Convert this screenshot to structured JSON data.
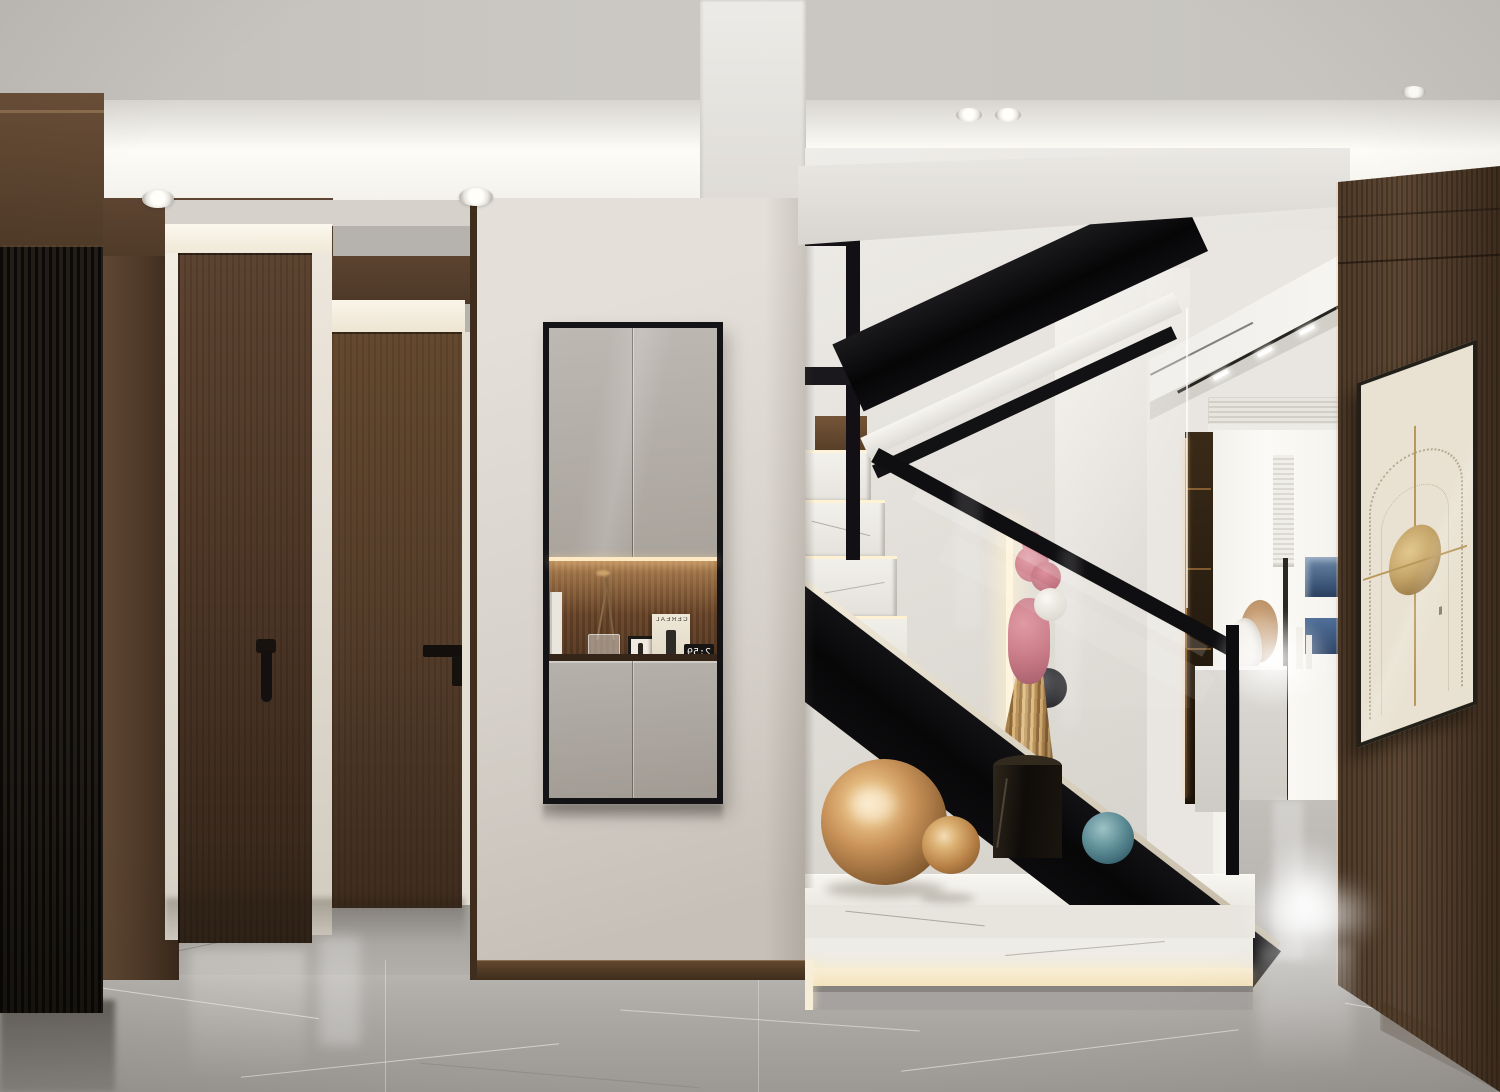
{
  "meta": {
    "type": "interior-render",
    "description": "Modern luxury home entry hall: dark walnut doors and black fluted panel on the left, greige wall with black-framed mirror shoe cabinet and lit display niche in the center, black steel staircase with glass balustrade and white marble platform with copper spheres at right, walnut feature wall with framed line artwork on the far right, gray marble floor, recessed cove-lit ceiling.",
    "canvas": {
      "width": 1500,
      "height": 1092
    }
  },
  "scene": {
    "ceiling": {
      "style": "recessed tray with warm cove lighting",
      "downlight_count": 5
    },
    "left_hallway": {
      "fluted_panel": "black vertical slatted panel",
      "doors": [
        {
          "label": "walnut door with black drop handle"
        },
        {
          "label": "walnut door with black bar handle"
        }
      ]
    },
    "entry_cabinet": {
      "label": "wall-hung cabinet, taupe doors, black frame",
      "niche": {
        "label": "wood-slat display niche with LED strip",
        "items": [
          "dried branches in glass vase",
          "small black photo frame",
          "magazine cover (mirrored)",
          "flip clock (mirrored)"
        ],
        "magazine_title": "CEREAL",
        "clock_time": "2:59"
      }
    },
    "staircase": {
      "structure": "black steel stringers and handrails, glass balustrade",
      "steps": "white marble winders with lit nosings",
      "platform": "two-tier white marble base with LED skirting",
      "decor": [
        "large copper sphere",
        "small copper sphere",
        "teal glass sphere",
        "black marble cylinder pedestal",
        "pink rabbit figurine with gold pleated skirt and white balloon"
      ]
    },
    "background_room": {
      "elements": [
        "linear AC vent",
        "track lights",
        "dark display cabinet with lit shelves",
        "window with pleated blind",
        "blue framed pictures",
        "white sideboard with decor",
        "floor lamp pole"
      ]
    },
    "right_wall": {
      "material": "walnut wood paneling",
      "artwork": "beige abstract arch line-art print in thin black frame"
    },
    "floor": "polished gray marble with white veining"
  },
  "palette": {
    "ceiling_gray": "#c8c5c0",
    "cove_glow": "#fdfcf7",
    "walnut_dark": "#4a3526",
    "walnut_mid": "#5d4431",
    "fluted_black": "#17140f",
    "wall_greige": "#d8d3cc",
    "cabinet_door": "#b5b0aa",
    "niche_wood": "#6e4c30",
    "stair_black": "#0d0c0e",
    "marble_white": "#f2f0eb",
    "floor_gray": "#aaa7a3",
    "copper": "#c89259",
    "teal_glass": "#4e7d8a",
    "pink_figure": "#cc7b86",
    "gold_art": "#b9995a",
    "led_warm": "#ffe9c4"
  }
}
